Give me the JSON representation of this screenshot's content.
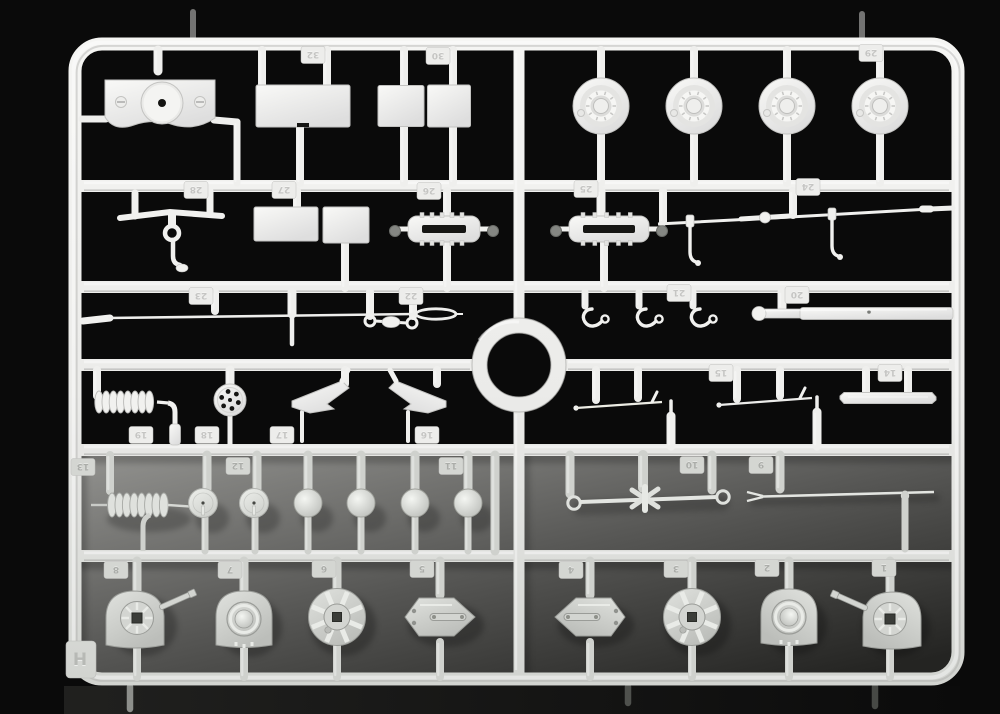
{
  "scene": {
    "kind": "photograph of injection-molded model kit sprue",
    "sprue_letter": "H",
    "background": "#0a0a0a",
    "backdrop": {
      "x": 81,
      "y": 456,
      "w": 871,
      "h": 218,
      "top": "#92928f",
      "mid": "#565654",
      "bottom": "#242422"
    },
    "frame": {
      "x1": 75,
      "y1": 44,
      "x2": 958,
      "y2": 679,
      "thickness": 13,
      "radius": 27
    },
    "rails_y": [
      186,
      287,
      365,
      450,
      556
    ],
    "spine_x": 519,
    "ring": {
      "cx": 519,
      "cy": 365,
      "r_mid": 39.5,
      "stroke": 15
    }
  },
  "colors": {
    "plastic_light": {
      "base": "#f1f1ef",
      "hi": "#ffffff",
      "sh": "#c3c3c1"
    },
    "plastic_mid": {
      "base": "#e6e8e4",
      "hi": "#f7f9f5",
      "sh": "#adafab"
    },
    "plastic_gray": {
      "base": "#d3d5d1",
      "hi": "#e9ebe7",
      "sh": "#9a9c98"
    },
    "hole_dark": "#161614",
    "tag_light_fill": "#ededeb",
    "tag_light_text": "#c5c5c3",
    "tag_gray_fill": "#d4d6d2",
    "tag_gray_text": "#abadA9"
  },
  "letter": {
    "text": "H",
    "x": 80,
    "y": 660
  },
  "tags": [
    {
      "n": "32",
      "x": 313,
      "y": 55,
      "shade": "L"
    },
    {
      "n": "30",
      "x": 438,
      "y": 56,
      "shade": "L"
    },
    {
      "n": "29",
      "x": 871,
      "y": 53,
      "shade": "L"
    },
    {
      "n": "28",
      "x": 196,
      "y": 190,
      "shade": "L"
    },
    {
      "n": "27",
      "x": 284,
      "y": 190,
      "shade": "L"
    },
    {
      "n": "26",
      "x": 429,
      "y": 191,
      "shade": "L"
    },
    {
      "n": "25",
      "x": 586,
      "y": 189,
      "shade": "L"
    },
    {
      "n": "24",
      "x": 808,
      "y": 187,
      "shade": "L"
    },
    {
      "n": "23",
      "x": 201,
      "y": 296,
      "shade": "L"
    },
    {
      "n": "22",
      "x": 411,
      "y": 296,
      "shade": "L"
    },
    {
      "n": "21",
      "x": 679,
      "y": 293,
      "shade": "L"
    },
    {
      "n": "20",
      "x": 797,
      "y": 295,
      "shade": "L"
    },
    {
      "n": "19",
      "x": 141,
      "y": 435,
      "shade": "L"
    },
    {
      "n": "18",
      "x": 207,
      "y": 435,
      "shade": "L"
    },
    {
      "n": "17",
      "x": 282,
      "y": 435,
      "shade": "L"
    },
    {
      "n": "16",
      "x": 427,
      "y": 435,
      "shade": "L"
    },
    {
      "n": "15",
      "x": 721,
      "y": 373,
      "shade": "L"
    },
    {
      "n": "14",
      "x": 890,
      "y": 373,
      "shade": "L"
    },
    {
      "n": "13",
      "x": 83,
      "y": 467,
      "shade": "G"
    },
    {
      "n": "12",
      "x": 238,
      "y": 466,
      "shade": "G"
    },
    {
      "n": "11",
      "x": 451,
      "y": 466,
      "shade": "G"
    },
    {
      "n": "10",
      "x": 692,
      "y": 465,
      "shade": "G"
    },
    {
      "n": "9",
      "x": 761,
      "y": 465,
      "shade": "G"
    },
    {
      "n": "8",
      "x": 116,
      "y": 570,
      "shade": "G"
    },
    {
      "n": "7",
      "x": 230,
      "y": 570,
      "shade": "G"
    },
    {
      "n": "6",
      "x": 324,
      "y": 569,
      "shade": "G"
    },
    {
      "n": "5",
      "x": 422,
      "y": 569,
      "shade": "G"
    },
    {
      "n": "4",
      "x": 571,
      "y": 570,
      "shade": "G"
    },
    {
      "n": "3",
      "x": 676,
      "y": 569,
      "shade": "G"
    },
    {
      "n": "2",
      "x": 767,
      "y": 568,
      "shade": "G"
    },
    {
      "n": "1",
      "x": 884,
      "y": 568,
      "shade": "G"
    }
  ],
  "parts": [
    {
      "n": 32,
      "name": "hull-plate",
      "type": "plate",
      "x": 152,
      "y": 105,
      "shade": "L"
    },
    {
      "n": 31,
      "name": "flat-panel",
      "type": "panel",
      "x": 303,
      "y": 106,
      "w": 94,
      "h": 42,
      "notch": true,
      "shade": "L"
    },
    {
      "n": 30,
      "name": "flat-panel",
      "type": "panel",
      "x": 401,
      "y": 106,
      "w": 46,
      "h": 41,
      "shade": "L"
    },
    {
      "n": 30,
      "name": "flat-panel",
      "type": "panel",
      "x": 449,
      "y": 106,
      "w": 43,
      "h": 42,
      "shade": "L"
    },
    {
      "n": 29,
      "name": "road-wheel",
      "type": "wheel",
      "x": 601,
      "y": 106,
      "shade": "L"
    },
    {
      "n": 29,
      "name": "road-wheel",
      "type": "wheel",
      "x": 694,
      "y": 106,
      "shade": "L"
    },
    {
      "n": 29,
      "name": "road-wheel",
      "type": "wheel",
      "x": 787,
      "y": 106,
      "shade": "L"
    },
    {
      "n": 29,
      "name": "road-wheel",
      "type": "wheel",
      "x": 880,
      "y": 106,
      "shade": "L"
    },
    {
      "n": 28,
      "name": "tow-hook-bar",
      "type": "towbar",
      "x": 172,
      "y": 212,
      "shade": "L"
    },
    {
      "n": 27,
      "name": "flat-panel",
      "type": "panel",
      "x": 286,
      "y": 224,
      "w": 64,
      "h": 34,
      "shade": "L"
    },
    {
      "n": 27,
      "name": "flat-panel",
      "type": "panel",
      "x": 346,
      "y": 225,
      "w": 46,
      "h": 36,
      "shade": "L"
    },
    {
      "n": 26,
      "name": "grille-frame",
      "type": "grille",
      "x": 444,
      "y": 229,
      "w": 72,
      "shade": "L"
    },
    {
      "n": 25,
      "name": "grille-frame",
      "type": "grille",
      "x": 609,
      "y": 229,
      "w": 80,
      "shade": "L"
    },
    {
      "n": 24,
      "name": "hinged-rod",
      "type": "hingerod",
      "x": 0,
      "y": 0,
      "shade": "L"
    },
    {
      "n": 23,
      "name": "tapered-rod",
      "type": "taperrod",
      "x": 0,
      "y": 0,
      "shade": "L"
    },
    {
      "n": 22,
      "name": "towing-link",
      "type": "link",
      "x": 391,
      "y": 321,
      "shade": "L"
    },
    {
      "n": 21,
      "name": "hook",
      "type": "hook",
      "x": 594,
      "y": 318,
      "shade": "L"
    },
    {
      "n": 21,
      "name": "hook",
      "type": "hook",
      "x": 648,
      "y": 318,
      "shade": "L"
    },
    {
      "n": 21,
      "name": "hook",
      "type": "hook",
      "x": 702,
      "y": 318,
      "shade": "L"
    },
    {
      "n": 20,
      "name": "cylinder-rod",
      "type": "cylrod",
      "x": 0,
      "y": 0,
      "shade": "L"
    },
    {
      "n": 19,
      "name": "coil-spring",
      "type": "springA",
      "x": 0,
      "y": 0,
      "shade": "L"
    },
    {
      "n": 18,
      "name": "drilled-disc",
      "type": "holedisc",
      "x": 230,
      "y": 400,
      "shade": "L"
    },
    {
      "n": 17,
      "name": "angled-bracket",
      "type": "bracket",
      "x": 322,
      "y": 398,
      "mirror": false,
      "shade": "L"
    },
    {
      "n": 16,
      "name": "angled-bracket",
      "type": "bracket",
      "x": 416,
      "y": 398,
      "mirror": true,
      "shade": "L"
    },
    {
      "n": 15,
      "name": "thin-rod",
      "type": "thinrod",
      "x": 0,
      "y": 0,
      "variant": 0,
      "shade": "L"
    },
    {
      "n": 15,
      "name": "thin-rod",
      "type": "thinrod",
      "x": 0,
      "y": 0,
      "variant": 1,
      "shade": "L"
    },
    {
      "n": 14,
      "name": "flat-bar",
      "type": "flatbar",
      "x": 888,
      "y": 398,
      "shade": "L"
    },
    {
      "n": 13,
      "name": "coil-spring",
      "type": "springB",
      "x": 0,
      "y": 0,
      "shade": "M"
    },
    {
      "n": 12,
      "name": "pin-disc",
      "type": "pindisc",
      "x": 203,
      "y": 503,
      "shade": "M"
    },
    {
      "n": 12,
      "name": "pin-disc",
      "type": "pindisc",
      "x": 254,
      "y": 503,
      "shade": "M"
    },
    {
      "n": 11,
      "name": "dome-cap",
      "type": "dome",
      "x": 308,
      "y": 503,
      "shade": "M"
    },
    {
      "n": 11,
      "name": "dome-cap",
      "type": "dome",
      "x": 361,
      "y": 503,
      "shade": "M"
    },
    {
      "n": 11,
      "name": "dome-cap",
      "type": "dome",
      "x": 415,
      "y": 503,
      "shade": "M"
    },
    {
      "n": 11,
      "name": "dome-cap",
      "type": "dome",
      "x": 468,
      "y": 503,
      "shade": "M"
    },
    {
      "n": 10,
      "name": "linkage-rod",
      "type": "linkrod",
      "x": 0,
      "y": 0,
      "shade": "M"
    },
    {
      "n": 9,
      "name": "forked-antenna",
      "type": "forkrod",
      "x": 0,
      "y": 0,
      "shade": "M"
    },
    {
      "n": 8,
      "name": "turret-shell",
      "type": "turret",
      "x": 137,
      "y": 618,
      "mirror": false,
      "shade": "G"
    },
    {
      "n": 7,
      "name": "cupola-plate",
      "type": "cupola",
      "x": 244,
      "y": 619,
      "mirror": false,
      "shade": "G"
    },
    {
      "n": 6,
      "name": "ribbed-hub",
      "type": "hubwheel",
      "x": 337,
      "y": 617,
      "shade": "G"
    },
    {
      "n": 5,
      "name": "hatch-plate",
      "type": "hexplate",
      "x": 440,
      "y": 617,
      "mirror": false,
      "shade": "G"
    },
    {
      "n": 4,
      "name": "hatch-plate",
      "type": "hexplate",
      "x": 590,
      "y": 617,
      "mirror": true,
      "shade": "G"
    },
    {
      "n": 3,
      "name": "ribbed-hub",
      "type": "hubwheel",
      "x": 692,
      "y": 617,
      "shade": "G"
    },
    {
      "n": 2,
      "name": "cupola-plate",
      "type": "cupola",
      "x": 789,
      "y": 617,
      "mirror": true,
      "shade": "G"
    },
    {
      "n": 1,
      "name": "turret-shell",
      "type": "turret",
      "x": 890,
      "y": 619,
      "mirror": true,
      "shade": "G"
    }
  ],
  "stubs": [
    [
      158,
      50,
      158,
      71,
      9
    ],
    [
      262,
      50,
      262,
      87,
      8
    ],
    [
      327,
      50,
      327,
      87,
      8
    ],
    [
      404,
      50,
      404,
      86,
      8
    ],
    [
      453,
      50,
      453,
      86,
      8
    ],
    [
      601,
      50,
      601,
      80,
      8
    ],
    [
      694,
      50,
      694,
      80,
      8
    ],
    [
      787,
      50,
      787,
      80,
      8
    ],
    [
      880,
      50,
      880,
      80,
      8
    ],
    [
      601,
      131,
      601,
      183,
      8
    ],
    [
      694,
      131,
      694,
      183,
      8
    ],
    [
      787,
      131,
      787,
      183,
      8
    ],
    [
      880,
      131,
      880,
      183,
      8
    ],
    [
      300,
      126,
      300,
      183,
      8
    ],
    [
      404,
      126,
      404,
      183,
      8
    ],
    [
      453,
      126,
      453,
      183,
      8
    ],
    [
      82,
      119,
      106,
      119,
      7
    ],
    [
      214,
      120,
      237,
      122,
      7
    ],
    [
      237,
      122,
      237,
      183,
      7
    ],
    [
      297,
      191,
      297,
      209,
      8
    ],
    [
      345,
      242,
      345,
      288,
      8
    ],
    [
      447,
      191,
      447,
      217,
      8
    ],
    [
      447,
      241,
      447,
      288,
      8
    ],
    [
      601,
      191,
      601,
      216,
      9
    ],
    [
      604,
      241,
      604,
      288,
      8
    ],
    [
      663,
      191,
      663,
      222,
      8
    ],
    [
      793,
      191,
      793,
      215,
      8
    ],
    [
      930,
      209,
      953,
      208,
      5
    ],
    [
      215,
      292,
      215,
      311,
      8
    ],
    [
      292,
      292,
      292,
      314,
      9
    ],
    [
      292,
      316,
      292,
      344,
      4.5
    ],
    [
      370,
      292,
      370,
      316,
      8
    ],
    [
      413,
      292,
      413,
      316,
      8
    ],
    [
      585,
      292,
      585,
      306,
      7
    ],
    [
      639,
      292,
      639,
      306,
      7
    ],
    [
      693,
      292,
      693,
      306,
      7
    ],
    [
      782,
      292,
      782,
      308,
      9
    ],
    [
      97,
      370,
      97,
      396,
      8
    ],
    [
      230,
      370,
      230,
      386,
      9
    ],
    [
      230,
      412,
      230,
      445,
      5
    ],
    [
      345,
      370,
      345,
      384,
      8
    ],
    [
      302,
      412,
      302,
      441,
      4
    ],
    [
      437,
      370,
      437,
      384,
      8
    ],
    [
      408,
      412,
      408,
      441,
      4
    ],
    [
      596,
      370,
      596,
      400,
      8
    ],
    [
      638,
      370,
      638,
      398,
      8
    ],
    [
      671,
      401,
      671,
      417,
      3.5
    ],
    [
      671,
      416,
      671,
      446,
      9
    ],
    [
      737,
      370,
      737,
      399,
      8
    ],
    [
      780,
      370,
      780,
      396,
      8
    ],
    [
      817,
      397,
      817,
      413,
      3.5
    ],
    [
      817,
      412,
      817,
      446,
      9
    ],
    [
      866,
      370,
      866,
      393,
      8
    ],
    [
      908,
      370,
      908,
      393,
      8
    ],
    [
      110,
      455,
      110,
      491,
      8
    ],
    [
      207,
      455,
      207,
      489,
      9
    ],
    [
      257,
      455,
      257,
      489,
      9
    ],
    [
      205,
      517,
      205,
      551,
      7
    ],
    [
      255,
      517,
      255,
      551,
      7
    ],
    [
      308,
      455,
      308,
      490,
      9
    ],
    [
      361,
      455,
      361,
      490,
      9
    ],
    [
      415,
      455,
      415,
      490,
      9
    ],
    [
      468,
      455,
      468,
      490,
      9
    ],
    [
      308,
      516,
      308,
      551,
      7
    ],
    [
      361,
      516,
      361,
      551,
      7
    ],
    [
      415,
      516,
      415,
      551,
      7
    ],
    [
      468,
      516,
      468,
      551,
      7
    ],
    [
      495,
      455,
      495,
      551,
      9
    ],
    [
      570,
      455,
      570,
      494,
      9
    ],
    [
      643,
      455,
      643,
      488,
      10
    ],
    [
      712,
      455,
      712,
      490,
      9
    ],
    [
      780,
      455,
      780,
      489,
      9
    ],
    [
      137,
      561,
      137,
      595,
      9
    ],
    [
      244,
      561,
      244,
      595,
      9
    ],
    [
      337,
      561,
      337,
      595,
      9
    ],
    [
      440,
      561,
      440,
      595,
      9
    ],
    [
      590,
      561,
      590,
      595,
      9
    ],
    [
      692,
      561,
      692,
      595,
      9
    ],
    [
      789,
      561,
      789,
      595,
      9
    ],
    [
      890,
      561,
      890,
      595,
      9
    ],
    [
      137,
      642,
      137,
      677,
      8
    ],
    [
      244,
      642,
      244,
      677,
      8
    ],
    [
      337,
      642,
      337,
      677,
      8
    ],
    [
      440,
      642,
      440,
      677,
      8
    ],
    [
      590,
      642,
      590,
      677,
      8
    ],
    [
      692,
      642,
      692,
      677,
      8
    ],
    [
      789,
      642,
      789,
      677,
      8
    ],
    [
      890,
      642,
      890,
      677,
      8
    ]
  ],
  "gates": {
    "top": [
      [
        193,
        12,
        39
      ],
      [
        862,
        14,
        39
      ]
    ],
    "bottom": [
      [
        130,
        687,
        709
      ],
      [
        628,
        687,
        703
      ],
      [
        875,
        687,
        706
      ]
    ]
  }
}
